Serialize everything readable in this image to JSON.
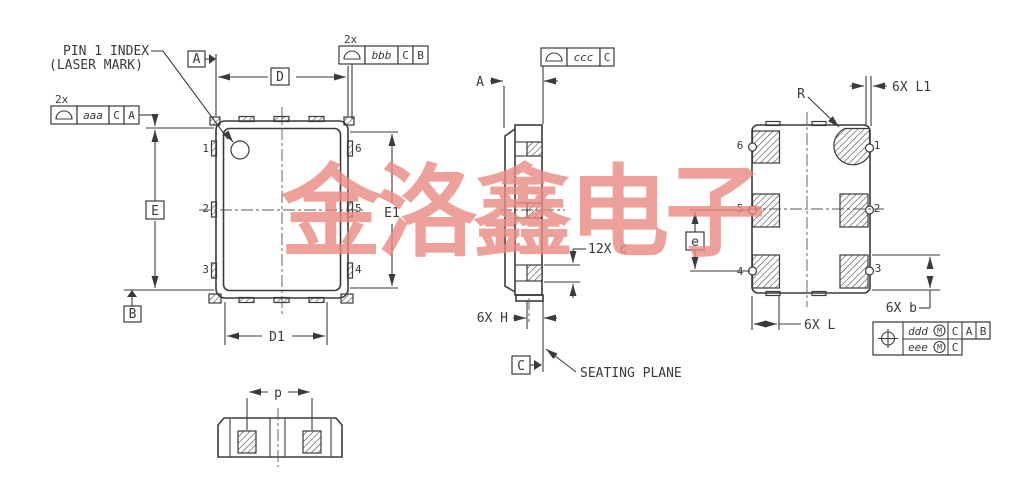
{
  "watermark": {
    "text": "金洛鑫电子",
    "color": "#e98a82"
  },
  "annotations": {
    "pin1_index_line1": "PIN 1 INDEX",
    "pin1_index_line2": "(LASER MARK)",
    "seating_plane": "SEATING PLANE"
  },
  "dims": {
    "D": "D",
    "D1": "D1",
    "E": "E",
    "E1": "E1",
    "p": "p",
    "A": "A",
    "e": "e",
    "R": "R",
    "c": "12X c",
    "H": "6X H",
    "L": "6X L",
    "L1": "6X L1",
    "b": "6X b"
  },
  "datum_flags": {
    "A": "A",
    "B": "B",
    "C": "C"
  },
  "fcf": {
    "aaa": {
      "qty": "2x",
      "symbol": "profile-of-a-surface",
      "tol": "aaa",
      "d1": "C",
      "d2": "A"
    },
    "bbb": {
      "qty": "2x",
      "symbol": "profile-of-a-surface",
      "tol": "bbb",
      "d1": "C",
      "d2": "B"
    },
    "ccc": {
      "symbol": "profile-of-a-surface",
      "tol": "ccc",
      "d1": "C"
    },
    "pos": {
      "symbol": "true-position",
      "row1": {
        "tol": "ddd",
        "mod": "M",
        "d1": "C",
        "d2": "A",
        "d3": "B"
      },
      "row2": {
        "tol": "eee",
        "mod": "M",
        "d1": "C"
      }
    }
  },
  "pins": {
    "n1": "1",
    "n2": "2",
    "n3": "3",
    "n4": "4",
    "n5": "5",
    "n6": "6"
  },
  "line_color": "#3b3b3b"
}
